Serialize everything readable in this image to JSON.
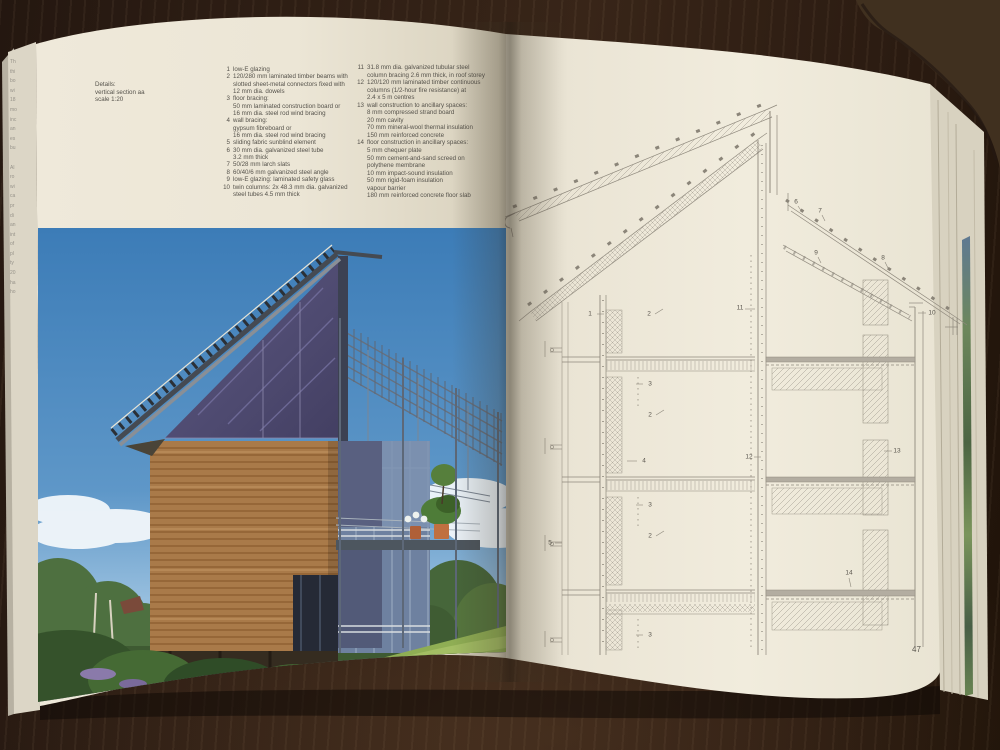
{
  "book": {
    "left_page": {
      "caption": "Details:\nvertical section aa\nscale 1:20",
      "legend_col1": [
        {
          "num": "1",
          "text": "low-E glazing"
        },
        {
          "num": "2",
          "text": "120/280 mm laminated timber beams with\nslotted sheet-metal connectors fixed with\n12 mm dia. dowels"
        },
        {
          "num": "3",
          "text": "floor bracing:\n50 mm laminated construction board or\n16 mm dia. steel rod wind bracing"
        },
        {
          "num": "4",
          "text": "wall bracing:\ngypsum fibreboard or\n16 mm dia. steel rod wind bracing"
        },
        {
          "num": "5",
          "text": "sliding fabric sunblind element"
        },
        {
          "num": "6",
          "text": "30 mm dia. galvanized steel tube\n3.2 mm thick"
        },
        {
          "num": "7",
          "text": "50/28 mm larch slats"
        },
        {
          "num": "8",
          "text": "60/40/6 mm galvanized steel angle"
        },
        {
          "num": "9",
          "text": "low-E glazing: laminated safety glass"
        },
        {
          "num": "10",
          "text": "twin columns: 2x 48.3 mm dia. galvanized\nsteel tubes 4.5 mm thick"
        }
      ],
      "legend_col2": [
        {
          "num": "11",
          "text": "31.8 mm dia. galvanized tubular steel\ncolumn bracing 2.6 mm thick, in roof storey"
        },
        {
          "num": "12",
          "text": "120/120 mm laminated timber continuous\ncolumns (1/2-hour fire resistance) at\n2.4 x 5 m centres"
        },
        {
          "num": "13",
          "text": "wall construction to ancillary spaces:\n8 mm compressed strand board\n20 mm cavity\n70 mm mineral-wool thermal insulation\n150 mm reinforced concrete"
        },
        {
          "num": "14",
          "text": "floor construction in ancillary spaces:\n5 mm chequer plate\n50 mm cement-and-sand screed on\npolythene membrane\n10 mm impact-sound insulation\n50 mm rigid-foam insulation\nvapour barrier\n180 mm reinforced concrete floor slab"
        }
      ]
    },
    "right_page": {
      "page_number": "47",
      "drawing": {
        "callouts": {
          "c1": "1",
          "c2": "2",
          "c3": "3",
          "c4": "4",
          "c5": "5",
          "c6": "6",
          "c7": "7",
          "c8": "8",
          "c9": "9",
          "c10": "10",
          "c11": "11",
          "c12": "12",
          "c13": "13",
          "c14": "14"
        }
      }
    },
    "edge_text_fragments": "Th\nthi\nbo\nwi\n18\nmo\ninc\nan\nes\nbu\n\nAl\nro\nwi\nca\npr\ndi\nan\nint\nof\npl\nty\n20\nha\nho"
  },
  "colors": {
    "table_wood": "#2c1c12",
    "page_cream": "#ece7d8",
    "sky_blue": "#4a87c0",
    "gable_glass_purple": "#575379",
    "timber_brown": "#b5824e",
    "foliage_green": "#4a6a38",
    "drawing_line_gray": "#8f897d",
    "text_gray": "#55524b"
  }
}
